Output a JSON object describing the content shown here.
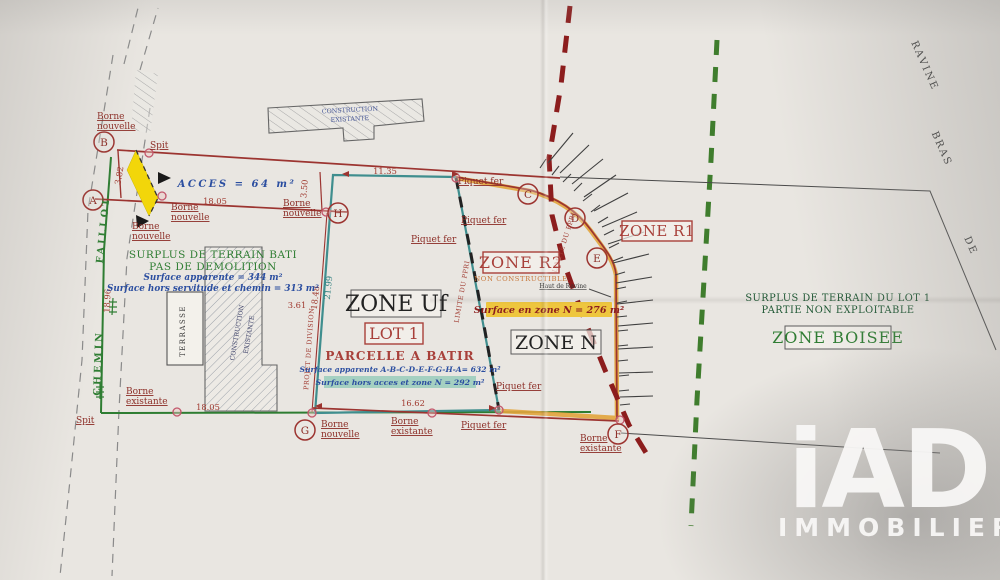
{
  "plan": {
    "points": {
      "A": "A",
      "B": "B",
      "C": "C",
      "D": "D",
      "E": "E",
      "F": "F",
      "G": "G",
      "H": "H"
    },
    "markers": {
      "borne": "Borne",
      "nouvelle": "nouvelle",
      "existante": "existante",
      "spit": "Spit",
      "piquet": "Piquet fer"
    },
    "measurements": {
      "m382": "3.82",
      "m1805": "18.05",
      "m350": "3.50",
      "m1135": "11.35",
      "m1896": "18.96",
      "m2199": "21.99",
      "m1848": "18.48",
      "m361": "3.61",
      "m1805b": "18.05",
      "m1662": "16.62"
    },
    "roads": {
      "chemin": "CHEMIN",
      "faillot": "FAILLOT",
      "ravine": "RAVINE",
      "bras": "BRAS",
      "de": "DE"
    },
    "limits": {
      "ppri": "LIMITE DU PPRI",
      "projet": "PROJET DE DIVISION",
      "haut_ravine": "Haut de Ravine"
    },
    "buildings": {
      "construction_l1": "CONSTRUCTION",
      "construction_l2": "EXISTANTE",
      "terrasse": "TERRASSE"
    },
    "acces": "ACCES = 64 m²",
    "left_parcel": {
      "title1": "SURPLUS DE TERRAIN BATI",
      "title2": "PAS DE DEMOLITION",
      "surface1": "Surface apparente = 344 m²",
      "surface2": "Surface hors servitude et chemin = 313 m²"
    },
    "lot1": {
      "zone": "ZONE Uf",
      "lot": "LOT 1",
      "sub": "PARCELLE A BATIR",
      "surface1": "Surface apparente A-B-C-D-E-F-G-H-A= 632 m²",
      "surface2": "Surface hors acces et zone N = 292 m²"
    },
    "zone_r2": {
      "title": "ZONE R2",
      "sub": "NON CONSTRUCTIBLE",
      "surface": "Surface en zone N = 276 m²"
    },
    "zone_n": "ZONE N",
    "zone_r1": "ZONE R1",
    "right_parcel": {
      "line1": "SURPLUS DE TERRAIN DU LOT 1",
      "line2": "PARTIE NON EXPLOITABLE",
      "zone": "ZONE BOISEE"
    }
  },
  "watermark": {
    "logo": "iAD",
    "name": "IMMOBILIER"
  },
  "colors": {
    "red": "#9c3430",
    "darkred": "#8c1d1d",
    "teal": "#3f8e8e",
    "green": "#2e7d32",
    "orange": "#e2a43c",
    "blue": "#2b4ea0",
    "yellow": "#f2d60a",
    "highlight": "#eec63e",
    "paper": "#e9e6e1"
  }
}
